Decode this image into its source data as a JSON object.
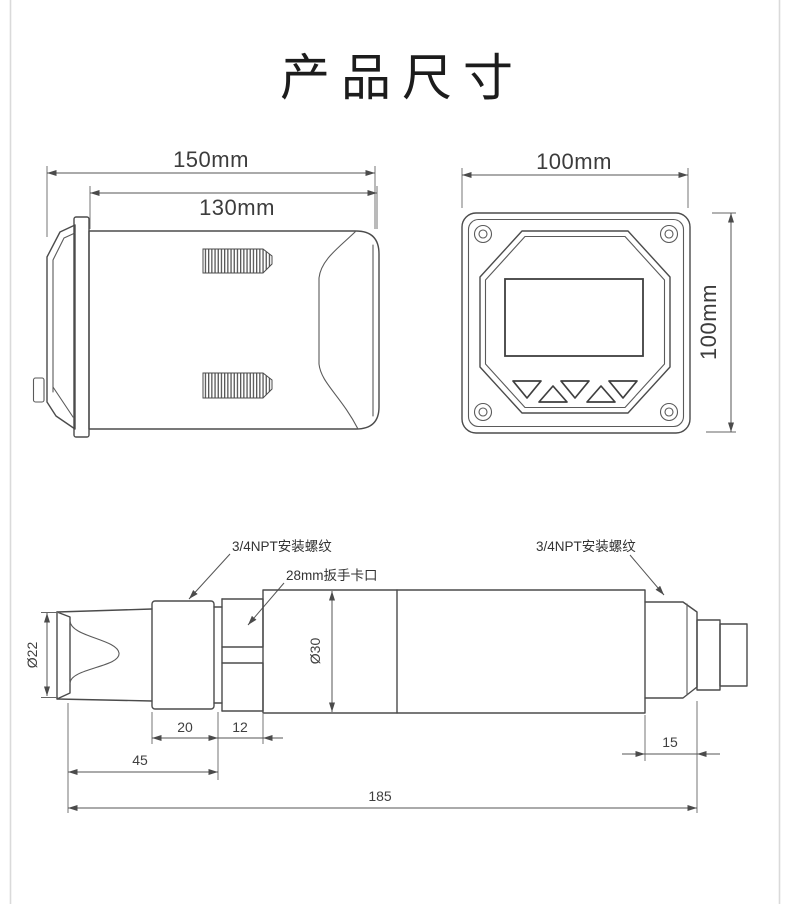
{
  "title": "产品尺寸",
  "colors": {
    "line": "#4b4b4b",
    "dim_text": "#3c3c3c",
    "page_border": "#dadada"
  },
  "side_view": {
    "dim_overall_width": "150mm",
    "dim_body_width": "130mm"
  },
  "front_view": {
    "dim_width": "100mm",
    "dim_height": "100mm"
  },
  "probe_view": {
    "label_front_thread": "3/4NPT安装螺纹",
    "label_wrench": "28mm扳手卡口",
    "label_rear_thread": "3/4NPT安装螺纹",
    "dim_tip_diameter": "Ø22",
    "dim_body_diameter": "Ø30",
    "dim_thread_length": "20",
    "dim_wrench_length": "12",
    "dim_front_length": "45",
    "dim_total_length": "185",
    "dim_rear_length": "15"
  }
}
